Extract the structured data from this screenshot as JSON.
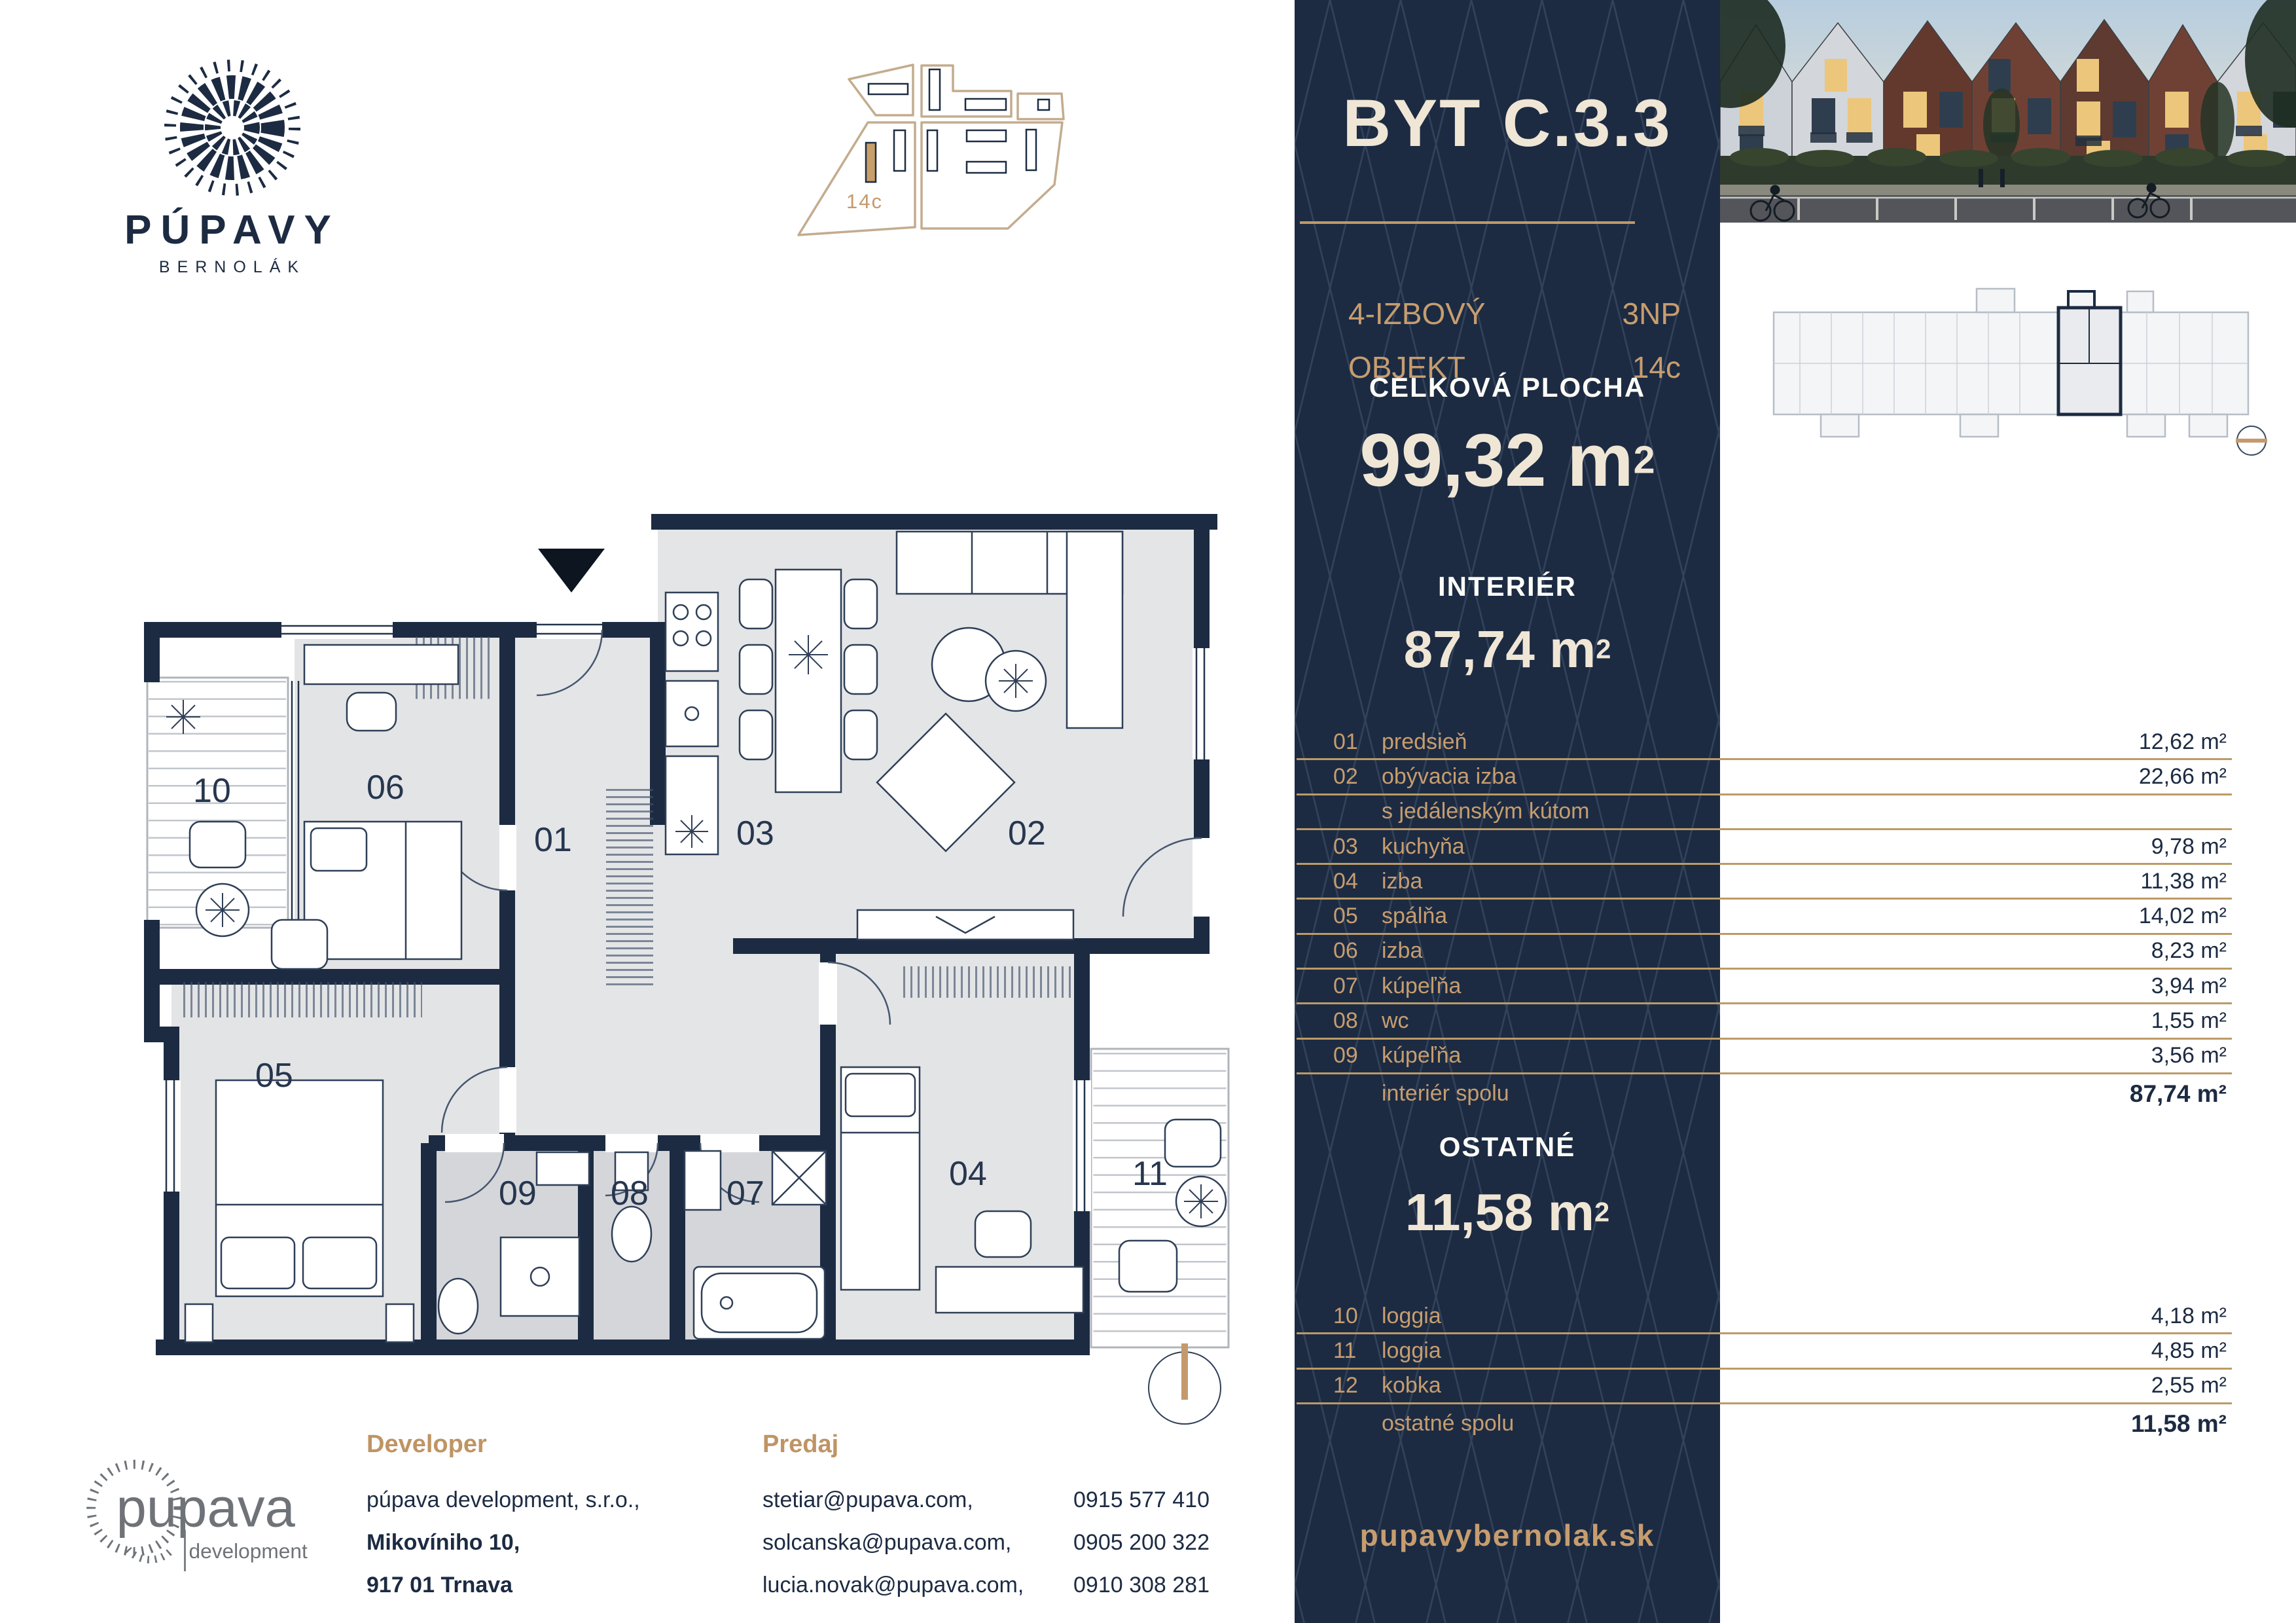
{
  "brand": {
    "name": "PÚPAVY",
    "subtitle": "BERNOLÁK"
  },
  "dev_logo": {
    "line1": "pupava",
    "line2": "development"
  },
  "site_plan": {
    "label": "14c"
  },
  "floor_plan": {
    "labels": {
      "r01": "01",
      "r02": "02",
      "r03": "03",
      "r04": "04",
      "r05": "05",
      "r06": "06",
      "r07": "07",
      "r08": "08",
      "r09": "09",
      "r10": "10",
      "r11": "11"
    }
  },
  "panel": {
    "title": "BYT C.3.3",
    "type_line1": "4-IZBOVÝ",
    "type_line2": "OBJEKT",
    "floor": "3NP",
    "object": "14c",
    "total_label": "CELKOVÁ PLOCHA",
    "total_value": "99,32 m",
    "total_sup": "2",
    "interior_label": "INTERIÉR",
    "interior_value": "87,74 m",
    "interior_sup": "2",
    "other_label": "OSTATNÉ",
    "other_value": "11,58 m",
    "other_sup": "2",
    "website": "pupavybernolak.sk"
  },
  "interior_rooms": [
    {
      "num": "01",
      "label": "predsieň",
      "area": "12,62 m²"
    },
    {
      "num": "02",
      "label": "obývacia izba",
      "area": "22,66 m²"
    },
    {
      "num": "",
      "label": "s jedálenským kútom",
      "area": ""
    },
    {
      "num": "03",
      "label": "kuchyňa",
      "area": "9,78 m²"
    },
    {
      "num": "04",
      "label": "izba",
      "area": "11,38 m²"
    },
    {
      "num": "05",
      "label": "spálňa",
      "area": "14,02 m²"
    },
    {
      "num": "06",
      "label": "izba",
      "area": "8,23 m²"
    },
    {
      "num": "07",
      "label": "kúpeľňa",
      "area": "3,94 m²"
    },
    {
      "num": "08",
      "label": "wc",
      "area": "1,55 m²"
    },
    {
      "num": "09",
      "label": "kúpeľňa",
      "area": "3,56 m²"
    }
  ],
  "interior_total": {
    "label": "interiér spolu",
    "area": "87,74 m²"
  },
  "other_rooms": [
    {
      "num": "10",
      "label": "loggia",
      "area": "4,18 m²"
    },
    {
      "num": "11",
      "label": "loggia",
      "area": "4,85 m²"
    },
    {
      "num": "12",
      "label": "kobka",
      "area": "2,55 m²"
    }
  ],
  "other_total": {
    "label": "ostatné spolu",
    "area": "11,58 m²"
  },
  "contacts": {
    "developer_heading": "Developer",
    "developer_name": "púpava development, s.r.o.,",
    "developer_street": "Mikovíniho 10,",
    "developer_city": "917 01 Trnava",
    "sales_heading": "Predaj",
    "sales": [
      {
        "email": "stetiar@pupava.com,",
        "phone": "0915 577 410"
      },
      {
        "email": "solcanska@pupava.com,",
        "phone": "0905 200 322"
      },
      {
        "email": "lucia.novak@pupava.com,",
        "phone": "0910 308 281"
      }
    ]
  }
}
